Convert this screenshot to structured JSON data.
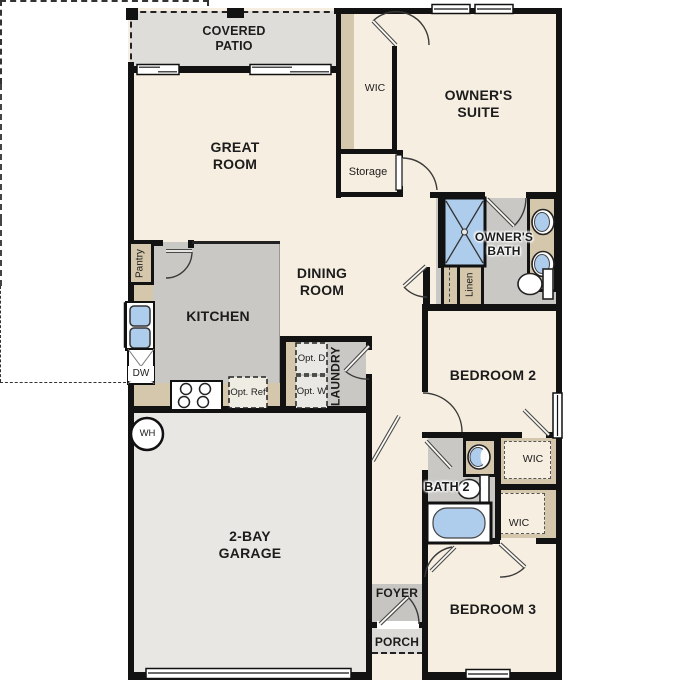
{
  "plan": {
    "rooms": {
      "covered_patio": "COVERED PATIO",
      "great_room": "GREAT ROOM",
      "owners_suite": "OWNER'S SUITE",
      "owners_wic": "WIC",
      "storage": "Storage",
      "owners_bath": "OWNER'S BATH",
      "linen": "Linen",
      "dining_room": "DINING ROOM",
      "kitchen": "KITCHEN",
      "pantry": "Pantry",
      "laundry": "LAUNDRY",
      "bedroom_2": "BEDROOM 2",
      "bath_2": "BATH 2",
      "bedroom_2_wic": "WIC",
      "bedroom_3_wic": "WIC",
      "bedroom_3": "BEDROOM 3",
      "garage": "2-BAY GARAGE",
      "foyer": "FOYER",
      "porch": "PORCH"
    },
    "fixtures": {
      "dishwasher": "DW",
      "water_heater": "WH",
      "optional_refrigerator": "Opt. Ref",
      "optional_dryer": "Opt. D",
      "optional_washer": "Opt. W"
    },
    "colors": {
      "cream": "#f6eee0",
      "gray": "#c9c8c5",
      "garage": "#e8e7e4",
      "patio": "#deddda",
      "foyer": "#c6c5c2",
      "porch": "#dcdbd8",
      "tan": "#d5c7ab",
      "blue": "#aecdec",
      "wall": "#121212",
      "text": "#1c1c1c"
    }
  }
}
